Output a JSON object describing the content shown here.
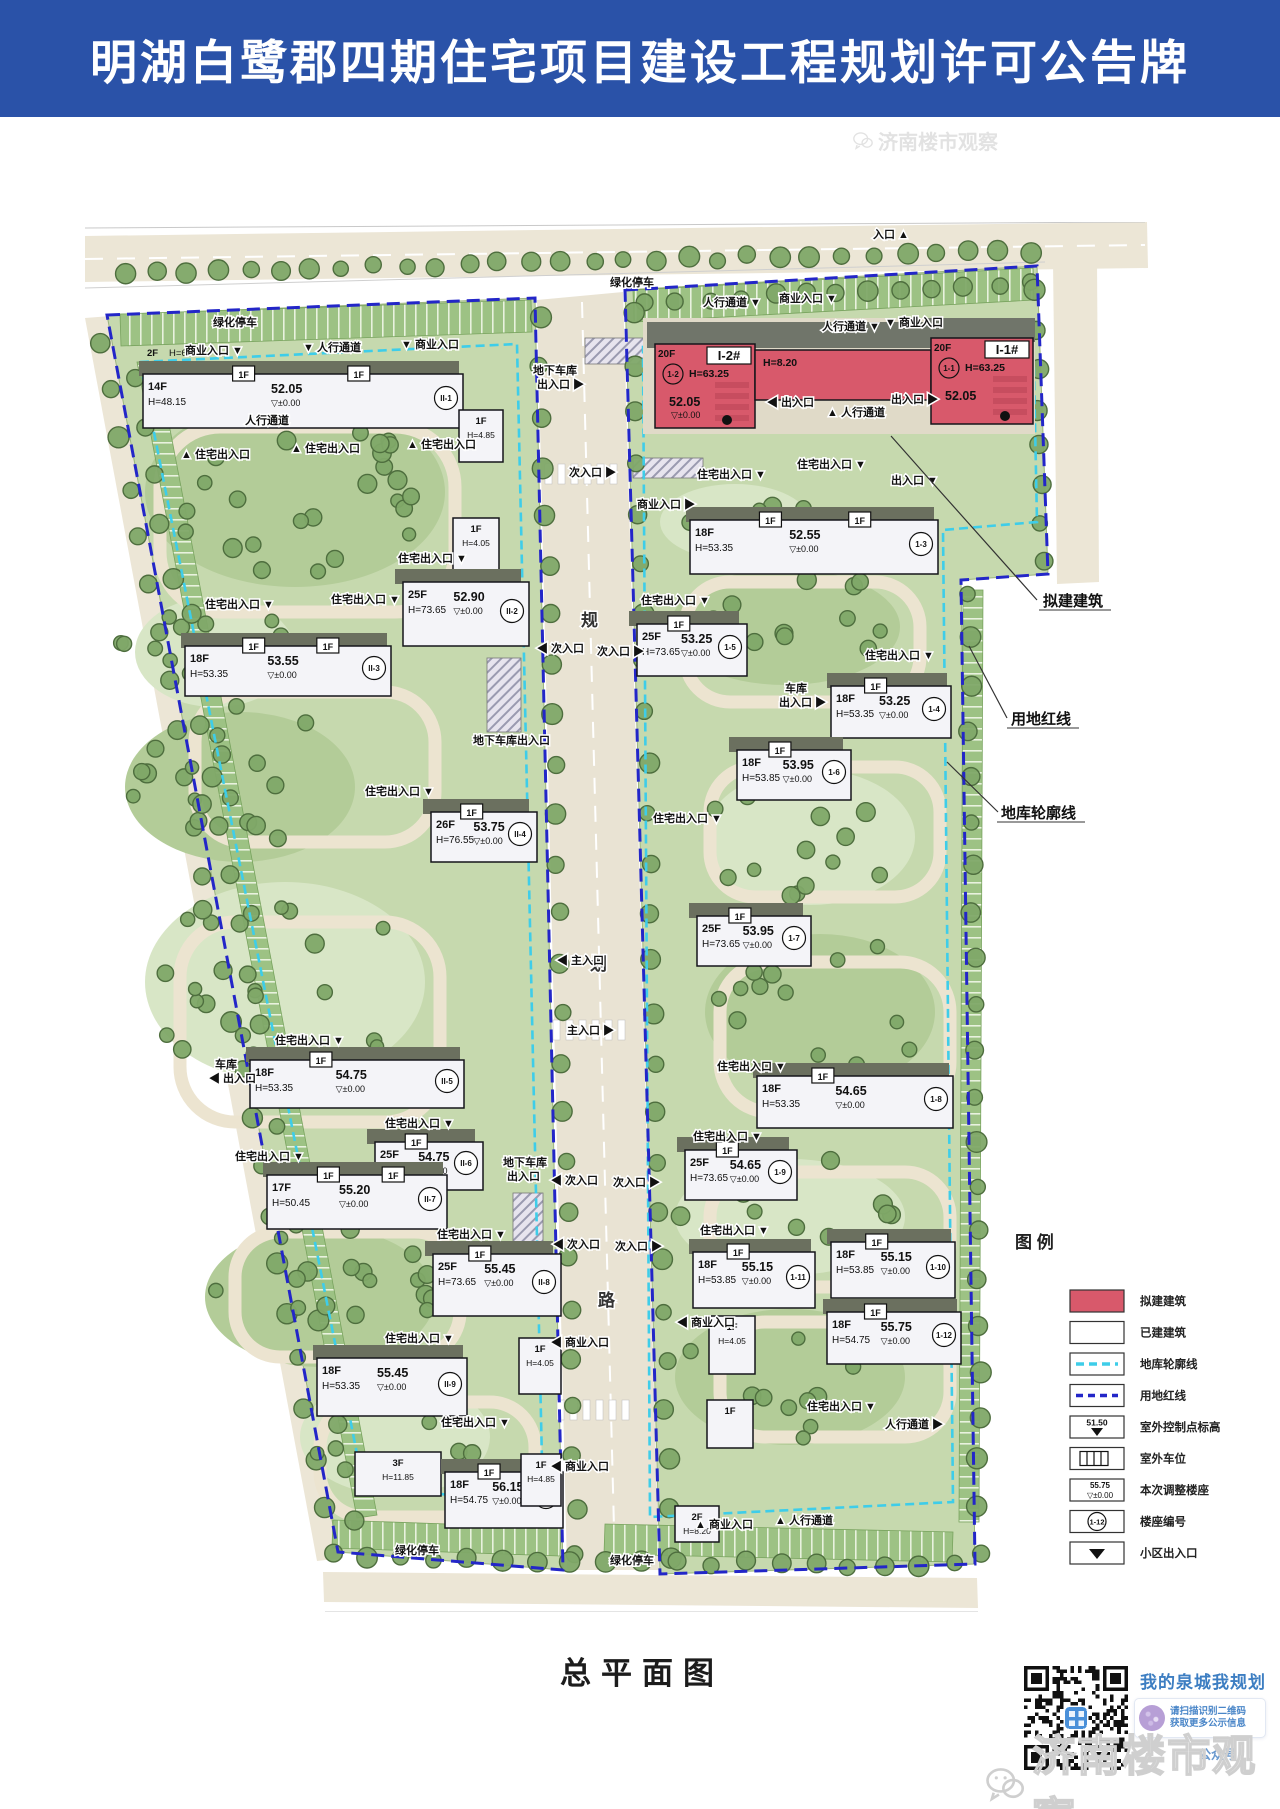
{
  "header": {
    "title": "明湖白鹭郡四期住宅项目建设工程规划许可公告牌"
  },
  "colors": {
    "accent_blue": "#2a52a8",
    "proposed_red": "#d8596b",
    "redline_blue": "#2326c8",
    "basement_cyan": "#3ecde9",
    "park_green": "#c6d9ae",
    "road_beige": "#ece6d6"
  },
  "plan": {
    "title": "总平面图",
    "road_name_chars": [
      "规",
      "划",
      "路"
    ],
    "tag_label": "1F",
    "callouts": [
      {
        "label": "拟建建筑",
        "x": 958,
        "y": 384,
        "line": [
          952,
          378,
          845,
          258,
          806,
          214
        ]
      },
      {
        "label": "用地红线",
        "x": 926,
        "y": 502,
        "line": [
          922,
          496,
          884,
          424
        ]
      },
      {
        "label": "地库轮廓线",
        "x": 916,
        "y": 596,
        "line": [
          913,
          590,
          862,
          540
        ]
      }
    ],
    "legend": {
      "title": "图  例",
      "items": [
        {
          "symbol": "red-box",
          "label": "拟建建筑"
        },
        {
          "symbol": "white-box",
          "label": "已建建筑"
        },
        {
          "symbol": "cyan-dash",
          "label": "地库轮廓线"
        },
        {
          "symbol": "blue-dash",
          "label": "用地红线"
        },
        {
          "symbol": "spot-elevation",
          "label": "室外控制点标高",
          "text": "51.50"
        },
        {
          "symbol": "parking",
          "label": "室外车位"
        },
        {
          "symbol": "adjusted",
          "label": "本次调整楼座",
          "text": "55.75",
          "text2": "±0.00"
        },
        {
          "symbol": "circle-code",
          "label": "楼座编号",
          "text": "1-12"
        },
        {
          "symbol": "triangle",
          "label": "小区出入口"
        }
      ]
    },
    "buildings": [
      {
        "id": "II-1",
        "type": "slab",
        "x": 58,
        "y": 152,
        "w": 320,
        "h": 54,
        "fl": "14F",
        "h1": "H=48.15",
        "elev": "52.05",
        "pm": "▽±0.00",
        "code": "II-1",
        "tags": 2,
        "extra_fl": "2F",
        "extra_h": "H=6.20"
      },
      {
        "id": "w-shop-1",
        "type": "small",
        "x": 374,
        "y": 188,
        "w": 44,
        "h": 52,
        "fl": "1F",
        "h1": "H=4.85"
      },
      {
        "id": "w-shop-2",
        "type": "small",
        "x": 368,
        "y": 296,
        "w": 46,
        "h": 54,
        "fl": "1F",
        "h1": "H=4.05"
      },
      {
        "id": "II-2",
        "type": "tower",
        "x": 318,
        "y": 360,
        "w": 126,
        "h": 64,
        "fl": "25F",
        "elev": "52.90",
        "h1": "H=73.65",
        "pm": "▽±0.00",
        "code": "II-2"
      },
      {
        "id": "II-3",
        "type": "slab",
        "x": 100,
        "y": 424,
        "w": 206,
        "h": 50,
        "fl": "18F",
        "h1": "H=53.35",
        "elev": "53.55",
        "pm": "▽±0.00",
        "code": "II-3",
        "tags": 2
      },
      {
        "id": "II-4",
        "type": "tower",
        "x": 346,
        "y": 590,
        "w": 106,
        "h": 50,
        "fl": "26F",
        "h1": "H=76.55",
        "elev": "53.75",
        "pm": "▽±0.00",
        "code": "II-4",
        "tags": 1
      },
      {
        "id": "II-5",
        "type": "slab",
        "x": 165,
        "y": 838,
        "w": 214,
        "h": 48,
        "fl": "18F",
        "h1": "H=53.35",
        "elev": "54.75",
        "pm": "▽±0.00",
        "code": "II-5",
        "tags": 1
      },
      {
        "id": "II-6",
        "type": "tower",
        "x": 290,
        "y": 920,
        "w": 108,
        "h": 48,
        "fl": "25F",
        "elev": "54.75",
        "h1": "H=76.55",
        "pm": "▽±0.00",
        "code": "II-6",
        "tags": 1
      },
      {
        "id": "II-7",
        "type": "slab",
        "x": 182,
        "y": 953,
        "w": 180,
        "h": 54,
        "fl": "17F",
        "elev": "55.20",
        "h1": "H=50.45",
        "pm": "▽±0.00",
        "code": "II-7",
        "tags": 2
      },
      {
        "id": "II-8",
        "type": "tower",
        "x": 348,
        "y": 1032,
        "w": 128,
        "h": 62,
        "fl": "25F",
        "h1": "H=73.65",
        "elev": "55.45",
        "pm": "▽±0.00",
        "code": "II-8",
        "tags": 1
      },
      {
        "id": "II-9",
        "type": "slab",
        "x": 232,
        "y": 1136,
        "w": 150,
        "h": 58,
        "fl": "18F",
        "h1": "H=53.35",
        "elev": "55.45",
        "pm": "▽±0.00",
        "code": "II-9"
      },
      {
        "id": "w-3f",
        "type": "small",
        "x": 270,
        "y": 1230,
        "w": 86,
        "h": 44,
        "fl": "3F",
        "h1": "H=11.85"
      },
      {
        "id": "II-10",
        "type": "slab",
        "x": 360,
        "y": 1250,
        "w": 118,
        "h": 56,
        "fl": "18F",
        "h1": "H=54.75",
        "elev": "56.15",
        "pm": "▽±0.00",
        "code": "II-10",
        "tags": 1
      },
      {
        "id": "w-shop-3",
        "type": "small",
        "x": 434,
        "y": 1116,
        "w": 42,
        "h": 56,
        "fl": "1F",
        "h1": "H=4.05"
      },
      {
        "id": "w-shop-4",
        "type": "small",
        "x": 436,
        "y": 1232,
        "w": 40,
        "h": 52,
        "fl": "1F",
        "h1": "H=4.85"
      },
      {
        "id": "I-2",
        "type": "red",
        "x": 570,
        "y": 122,
        "w": 100,
        "h": 84,
        "name": "I-2#",
        "fl": "20F",
        "h1": "H=63.25",
        "elev": "52.05",
        "pm": "▽±0.00",
        "code": "1-2"
      },
      {
        "id": "red-link",
        "type": "redslab",
        "x": 670,
        "y": 128,
        "w": 176,
        "h": 50,
        "h1": "H=8.20"
      },
      {
        "id": "I-1",
        "type": "red",
        "x": 846,
        "y": 116,
        "w": 102,
        "h": 86,
        "name": "I-1#",
        "fl": "20F",
        "h1": "H=63.25",
        "elev": "52.05",
        "code": "1-1"
      },
      {
        "id": "1-3",
        "type": "slab",
        "x": 605,
        "y": 298,
        "w": 248,
        "h": 54,
        "fl": "18F",
        "h1": "H=53.35",
        "elev": "52.55",
        "pm": "▽±0.00",
        "code": "1-3",
        "tags": 2
      },
      {
        "id": "1-5",
        "type": "tower",
        "x": 552,
        "y": 402,
        "w": 110,
        "h": 52,
        "fl": "25F",
        "elev": "53.25",
        "h1": "H=73.65",
        "pm": "▽±0.00",
        "code": "1-5",
        "tags": 1
      },
      {
        "id": "1-4",
        "type": "slab",
        "x": 746,
        "y": 464,
        "w": 120,
        "h": 52,
        "fl": "18F",
        "h1": "H=53.35",
        "elev": "53.25",
        "pm": "▽±0.00",
        "code": "1-4",
        "tags": 1
      },
      {
        "id": "1-6",
        "type": "tower",
        "x": 652,
        "y": 528,
        "w": 114,
        "h": 50,
        "fl": "18F",
        "h1": "H=53.85",
        "elev": "53.95",
        "pm": "▽±0.00",
        "code": "1-6",
        "tags": 1
      },
      {
        "id": "1-7",
        "type": "tower",
        "x": 612,
        "y": 694,
        "w": 114,
        "h": 50,
        "fl": "25F",
        "elev": "53.95",
        "h1": "H=73.65",
        "pm": "▽±0.00",
        "code": "1-7",
        "tags": 1
      },
      {
        "id": "1-8",
        "type": "slab",
        "x": 672,
        "y": 854,
        "w": 196,
        "h": 52,
        "fl": "18F",
        "h1": "H=53.35",
        "elev": "54.65",
        "pm": "▽±0.00",
        "code": "1-8",
        "tags": 1
      },
      {
        "id": "1-9",
        "type": "tower",
        "x": 600,
        "y": 928,
        "w": 112,
        "h": 50,
        "fl": "25F",
        "h1": "H=73.65",
        "elev": "54.65",
        "pm": "▽±0.00",
        "code": "1-9",
        "tags": 1
      },
      {
        "id": "1-11",
        "type": "slab",
        "x": 608,
        "y": 1030,
        "w": 122,
        "h": 56,
        "fl": "18F",
        "h1": "H=53.85",
        "elev": "55.15",
        "pm": "▽±0.00",
        "code": "1-11",
        "tags": 1
      },
      {
        "id": "1-10",
        "type": "slab",
        "x": 746,
        "y": 1020,
        "w": 124,
        "h": 56,
        "fl": "18F",
        "h1": "H=53.85",
        "elev": "55.15",
        "pm": "▽±0.00",
        "code": "1-10",
        "tags": 1
      },
      {
        "id": "1-12",
        "type": "slab",
        "x": 742,
        "y": 1090,
        "w": 134,
        "h": 52,
        "fl": "18F",
        "h1": "H=54.75",
        "elev": "55.75",
        "pm": "▽±0.00",
        "code": "1-12",
        "tags": 1
      },
      {
        "id": "e-shop-1",
        "type": "small",
        "x": 624,
        "y": 1094,
        "w": 46,
        "h": 58,
        "fl": "1F",
        "h1": "H=4.05"
      },
      {
        "id": "e-shop-2",
        "type": "small",
        "x": 622,
        "y": 1178,
        "w": 46,
        "h": 48,
        "fl": "1F"
      },
      {
        "id": "e-2f",
        "type": "small",
        "x": 590,
        "y": 1284,
        "w": 44,
        "h": 36,
        "fl": "2F",
        "h1": "H=8.20"
      }
    ],
    "labels": [
      {
        "text": "入口",
        "x": 788,
        "y": 16,
        "tri": "▲",
        "pos": "after"
      },
      {
        "text": "绿化停车",
        "x": 128,
        "y": 104
      },
      {
        "text": "商业入口",
        "x": 100,
        "y": 132,
        "tri": "▼",
        "pos": "after"
      },
      {
        "text": "人行通道",
        "x": 218,
        "y": 129,
        "tri": "▼",
        "pos": "before"
      },
      {
        "text": "商业入口",
        "x": 316,
        "y": 126,
        "tri": "▼",
        "pos": "before"
      },
      {
        "text": "绿化停车",
        "x": 525,
        "y": 64
      },
      {
        "text": "人行通道",
        "x": 618,
        "y": 84,
        "tri": "▼",
        "pos": "after"
      },
      {
        "text": "商业入口",
        "x": 694,
        "y": 80,
        "tri": "▼",
        "pos": "after"
      },
      {
        "text": "人行通道",
        "x": 737,
        "y": 108,
        "tri": "▼",
        "pos": "after"
      },
      {
        "text": "商业入口",
        "x": 800,
        "y": 104,
        "tri": "▼",
        "pos": "before"
      },
      {
        "text": "人行通道",
        "x": 160,
        "y": 202
      },
      {
        "text": "住宅出入口",
        "x": 96,
        "y": 236,
        "tri": "▲",
        "pos": "before"
      },
      {
        "text": "住宅出入口",
        "x": 206,
        "y": 230,
        "tri": "▲",
        "pos": "before"
      },
      {
        "text": "住宅出入口",
        "x": 322,
        "y": 226,
        "tri": "▲",
        "pos": "before"
      },
      {
        "text": "地下车库",
        "x": 448,
        "y": 152
      },
      {
        "text": "出入口",
        "x": 452,
        "y": 166,
        "tri": "▶",
        "pos": "after"
      },
      {
        "text": "出入口",
        "x": 682,
        "y": 184,
        "tri": "◀",
        "pos": "before"
      },
      {
        "text": "人行通道",
        "x": 742,
        "y": 194,
        "tri": "▲",
        "pos": "before"
      },
      {
        "text": "出入口",
        "x": 806,
        "y": 181,
        "tri": "▶",
        "pos": "after"
      },
      {
        "text": "次入口",
        "x": 484,
        "y": 254,
        "tri": "▶",
        "pos": "after"
      },
      {
        "text": "商业入口",
        "x": 552,
        "y": 286,
        "tri": "▶",
        "pos": "after"
      },
      {
        "text": "住宅出入口",
        "x": 612,
        "y": 256,
        "tri": "▼",
        "pos": "after"
      },
      {
        "text": "住宅出入口",
        "x": 712,
        "y": 246,
        "tri": "▼",
        "pos": "after"
      },
      {
        "text": "出入口",
        "x": 806,
        "y": 262,
        "tri": "▼",
        "pos": "after"
      },
      {
        "text": "住宅出入口",
        "x": 313,
        "y": 340,
        "tri": "▼",
        "pos": "after"
      },
      {
        "text": "住宅出入口",
        "x": 120,
        "y": 386,
        "tri": "▼",
        "pos": "after"
      },
      {
        "text": "住宅出入口",
        "x": 246,
        "y": 381,
        "tri": "▼",
        "pos": "after"
      },
      {
        "text": "住宅出入口",
        "x": 556,
        "y": 382,
        "tri": "▼",
        "pos": "after"
      },
      {
        "text": "住宅出入口",
        "x": 780,
        "y": 437,
        "tri": "▼",
        "pos": "after"
      },
      {
        "text": "次入口",
        "x": 452,
        "y": 430,
        "tri": "◀",
        "pos": "before"
      },
      {
        "text": "次入口",
        "x": 512,
        "y": 433,
        "tri": "▶",
        "pos": "after"
      },
      {
        "text": "地下车库出入口",
        "x": 388,
        "y": 522
      },
      {
        "text": "住宅出入口",
        "x": 280,
        "y": 573,
        "tri": "▼",
        "pos": "after"
      },
      {
        "text": "住宅出入口",
        "x": 568,
        "y": 600,
        "tri": "▼",
        "pos": "after"
      },
      {
        "text": "车库",
        "x": 700,
        "y": 470
      },
      {
        "text": "出入口",
        "x": 694,
        "y": 484,
        "tri": "▶",
        "pos": "after"
      },
      {
        "text": "主入口",
        "x": 472,
        "y": 742,
        "tri": "◀",
        "pos": "before"
      },
      {
        "text": "主入口",
        "x": 482,
        "y": 812,
        "tri": "▶",
        "pos": "after"
      },
      {
        "text": "住宅出入口",
        "x": 632,
        "y": 848,
        "tri": "▼",
        "pos": "after"
      },
      {
        "text": "车库",
        "x": 130,
        "y": 846
      },
      {
        "text": "出入口",
        "x": 124,
        "y": 860,
        "tri": "◀",
        "pos": "before"
      },
      {
        "text": "住宅出入口",
        "x": 190,
        "y": 822,
        "tri": "▼",
        "pos": "after"
      },
      {
        "text": "住宅出入口",
        "x": 300,
        "y": 905,
        "tri": "▼",
        "pos": "after"
      },
      {
        "text": "地下车库",
        "x": 418,
        "y": 944
      },
      {
        "text": "出入口",
        "x": 422,
        "y": 958
      },
      {
        "text": "次入口",
        "x": 466,
        "y": 962,
        "tri": "◀",
        "pos": "before"
      },
      {
        "text": "次入口",
        "x": 528,
        "y": 964,
        "tri": "▶",
        "pos": "after"
      },
      {
        "text": "住宅出入口",
        "x": 150,
        "y": 938,
        "tri": "▼",
        "pos": "after"
      },
      {
        "text": "住宅出入口",
        "x": 608,
        "y": 918,
        "tri": "▼",
        "pos": "after"
      },
      {
        "text": "住宅出入口",
        "x": 352,
        "y": 1016,
        "tri": "▼",
        "pos": "after"
      },
      {
        "text": "住宅出入口",
        "x": 615,
        "y": 1012,
        "tri": "▼",
        "pos": "after"
      },
      {
        "text": "次入口",
        "x": 468,
        "y": 1026,
        "tri": "◀",
        "pos": "before"
      },
      {
        "text": "次入口",
        "x": 530,
        "y": 1028,
        "tri": "▶",
        "pos": "after"
      },
      {
        "text": "商业入口",
        "x": 466,
        "y": 1124,
        "tri": "◀",
        "pos": "before"
      },
      {
        "text": "商业入口",
        "x": 592,
        "y": 1104,
        "tri": "◀",
        "pos": "before"
      },
      {
        "text": "住宅出入口",
        "x": 300,
        "y": 1120,
        "tri": "▼",
        "pos": "after"
      },
      {
        "text": "住宅出入口",
        "x": 356,
        "y": 1204,
        "tri": "▼",
        "pos": "after"
      },
      {
        "text": "住宅出入口",
        "x": 722,
        "y": 1188,
        "tri": "▼",
        "pos": "after"
      },
      {
        "text": "人行通道",
        "x": 800,
        "y": 1206,
        "tri": "▶",
        "pos": "after"
      },
      {
        "text": "商业入口",
        "x": 466,
        "y": 1248,
        "tri": "◀",
        "pos": "before"
      },
      {
        "text": "商业入口",
        "x": 610,
        "y": 1306,
        "tri": "▲",
        "pos": "before"
      },
      {
        "text": "人行通道",
        "x": 690,
        "y": 1302,
        "tri": "▲",
        "pos": "before"
      },
      {
        "text": "绿化停车",
        "x": 310,
        "y": 1332
      },
      {
        "text": "绿化停车",
        "x": 525,
        "y": 1342
      }
    ]
  },
  "footer": {
    "qr_title": "我的泉城我规划",
    "note_line1": "请扫描识别二维码",
    "note_line2": "获取更多公示信息",
    "partial_text": "公众号",
    "watermark": "济南楼市观察"
  }
}
